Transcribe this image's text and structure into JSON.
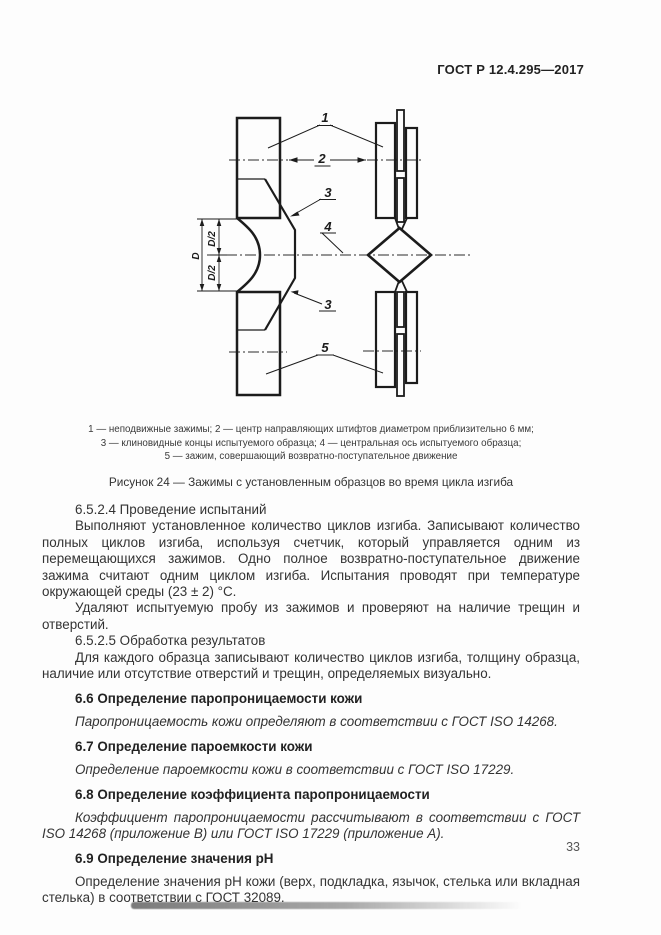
{
  "page": {
    "header": "ГОСТ Р 12.4.295—2017",
    "page_number": "33"
  },
  "figure": {
    "labels": {
      "n1": "1",
      "n2": "2",
      "n3_top": "3",
      "n3_bottom": "3",
      "n4": "4",
      "n5": "5",
      "dim_d": "D",
      "dim_d2_top": "D/2",
      "dim_d2_bottom": "D/2"
    },
    "legend_lines": [
      "1 — неподвижные зажимы; 2 — центр направляющих штифтов диаметром приблизительно 6 мм;",
      "3 — клиновидные концы испытуемого образца; 4 — центральная ось испытуемого образца;",
      "5 — зажим, совершающий возвратно-поступательное движение"
    ],
    "caption": "Рисунок 24 — Зажимы с установленным образцов во время цикла изгиба"
  },
  "body": {
    "blocks": [
      {
        "style": "plain",
        "text": "6.5.2.4 Проведение испытаний"
      },
      {
        "style": "plain",
        "text": "Выполняют установленное количество циклов изгиба. Записывают количество полных циклов изгиба, используя счетчик, который управляется одним из перемещающихся зажимов. Одно полное возвратно-поступательное движение зажима считают одним циклом изгиба. Испытания проводят при температуре окружающей среды (23 ± 2) °С."
      },
      {
        "style": "plain",
        "text": "Удаляют испытуемую пробу из зажимов и проверяют на наличие трещин и отверстий."
      },
      {
        "style": "plain",
        "text": "6.5.2.5 Обработка результатов"
      },
      {
        "style": "plain",
        "text": "Для каждого образца записывают количество циклов изгиба, толщину образца, наличие или отсутствие отверстий и трещин, определяемых визуально."
      },
      {
        "style": "heading",
        "text": "6.6 Определение паропроницаемости кожи"
      },
      {
        "style": "em",
        "text": "Паропроницаемость кожи определяют в соответствии с ГОСТ ISO 14268."
      },
      {
        "style": "heading",
        "text": "6.7 Определение пароемкости кожи"
      },
      {
        "style": "em",
        "text": "Определение пароемкости кожи в соответствии с ГОСТ ISO 17229."
      },
      {
        "style": "heading",
        "text": "6.8 Определение коэффициента паропроницаемости"
      },
      {
        "style": "em",
        "text": "Коэффициент паропроницаемости рассчитывают в соответствии с ГОСТ ISO 14268 (приложение B) или ГОСТ ISO 17229 (приложение А)."
      },
      {
        "style": "heading",
        "text": "6.9 Определение значения pH"
      },
      {
        "style": "plain",
        "text": "Определение значения pH кожи (верх, подкладка, язычок, стелька или вкладная стелька) в соответствии с ГОСТ 32089."
      }
    ]
  }
}
